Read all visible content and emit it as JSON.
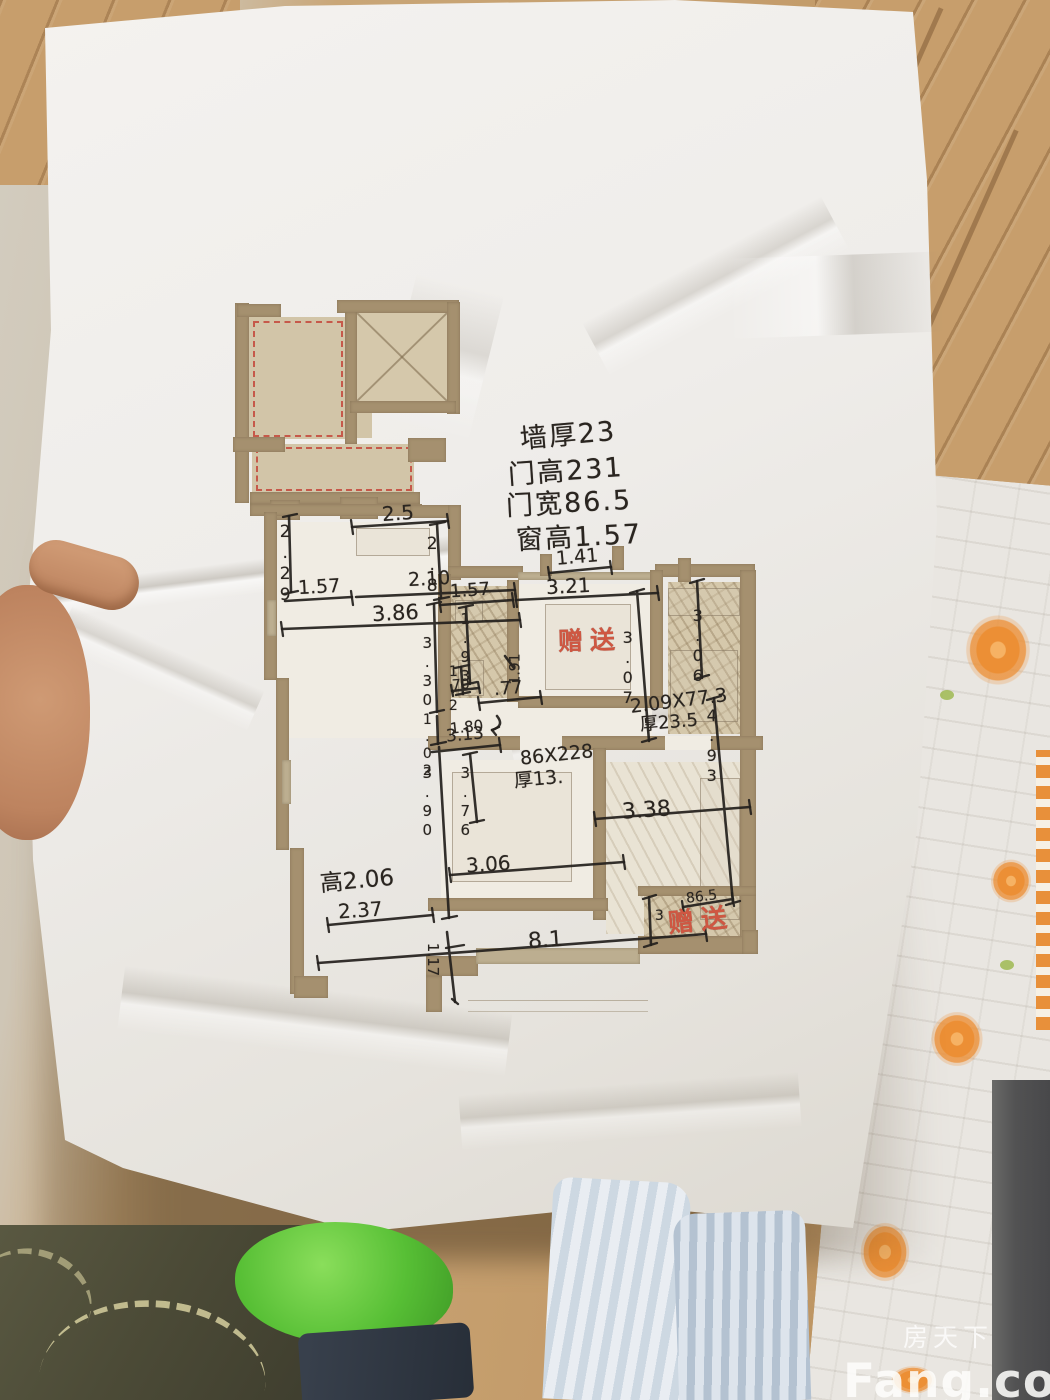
{
  "photo": {
    "watermark": {
      "site_cn": "房天下",
      "site_en": "Fang.com"
    },
    "handwritten_notes": [
      {
        "text": "墙厚23",
        "x": 520,
        "y": 422,
        "rot": -5,
        "size": 27
      },
      {
        "text": "门高231",
        "x": 508,
        "y": 458,
        "rot": -4,
        "size": 27
      },
      {
        "text": "门宽86.5",
        "x": 506,
        "y": 490,
        "rot": -3,
        "size": 27
      },
      {
        "text": "窗高1.57",
        "x": 516,
        "y": 524,
        "rot": -3,
        "size": 27
      }
    ],
    "gift_labels": [
      {
        "text": "赠送",
        "x": 558,
        "y": 628,
        "rot": -2,
        "size": 25
      },
      {
        "text": "赠送",
        "x": 668,
        "y": 908,
        "rot": -6,
        "size": 26
      }
    ],
    "dimensions": [
      {
        "text": "2.29",
        "x": 277,
        "y": 522,
        "dir": "v",
        "size": 17
      },
      {
        "text": "2.5",
        "x": 382,
        "y": 503,
        "dir": "h",
        "size": 20,
        "rot": -4
      },
      {
        "text": "2.8",
        "x": 424,
        "y": 534,
        "dir": "v",
        "size": 17
      },
      {
        "text": "1.41",
        "x": 556,
        "y": 548,
        "dir": "h",
        "size": 19,
        "rot": -5
      },
      {
        "text": "1.57",
        "x": 298,
        "y": 578,
        "dir": "h",
        "size": 19,
        "rot": -3
      },
      {
        "text": "2.10",
        "x": 408,
        "y": 570,
        "dir": "h",
        "size": 19,
        "rot": -3
      },
      {
        "text": "3.86",
        "x": 372,
        "y": 603,
        "dir": "h",
        "size": 21,
        "rot": -3
      },
      {
        "text": "1.57",
        "x": 450,
        "y": 582,
        "dir": "h",
        "size": 18,
        "rot": -4
      },
      {
        "text": "3.21",
        "x": 546,
        "y": 576,
        "dir": "h",
        "size": 20,
        "rot": -3
      },
      {
        "text": "1.93",
        "x": 458,
        "y": 610,
        "dir": "v",
        "size": 15
      },
      {
        "text": "70",
        "x": 452,
        "y": 678,
        "dir": "h",
        "size": 14,
        "rot": -4
      },
      {
        "text": ".77",
        "x": 494,
        "y": 680,
        "dir": "h",
        "size": 18,
        "rot": -4
      },
      {
        "text": "1.91",
        "x": 500,
        "y": 662,
        "dir": "r",
        "size": 14,
        "rot": -90
      },
      {
        "text": "3.30",
        "x": 420,
        "y": 634,
        "dir": "v",
        "size": 15
      },
      {
        "text": "1.2",
        "x": 446,
        "y": 664,
        "dir": "v",
        "size": 14
      },
      {
        "text": "1.80",
        "x": 450,
        "y": 720,
        "dir": "h",
        "size": 15,
        "rot": -6
      },
      {
        "text": "1.02",
        "x": 420,
        "y": 712,
        "dir": "v",
        "size": 14
      },
      {
        "text": "3.90",
        "x": 420,
        "y": 764,
        "dir": "v",
        "size": 15
      },
      {
        "text": "3.07",
        "x": 620,
        "y": 628,
        "dir": "v",
        "size": 16
      },
      {
        "text": "3.06",
        "x": 690,
        "y": 606,
        "dir": "v",
        "size": 16
      },
      {
        "text": "4.93",
        "x": 704,
        "y": 706,
        "dir": "v",
        "size": 16
      },
      {
        "text": "3.13",
        "x": 446,
        "y": 727,
        "dir": "h",
        "size": 17,
        "rot": -5
      },
      {
        "text": "3.76",
        "x": 458,
        "y": 764,
        "dir": "v",
        "size": 15
      },
      {
        "text": "86X228",
        "x": 520,
        "y": 746,
        "dir": "h",
        "size": 19,
        "rot": -6
      },
      {
        "text": "厚13.",
        "x": 514,
        "y": 770,
        "dir": "h",
        "size": 19,
        "rot": -5
      },
      {
        "text": "2.09X77.3",
        "x": 630,
        "y": 692,
        "dir": "h",
        "size": 19,
        "rot": -7
      },
      {
        "text": "厚23.5",
        "x": 640,
        "y": 714,
        "dir": "h",
        "size": 18,
        "rot": -5
      },
      {
        "text": "3.38",
        "x": 622,
        "y": 800,
        "dir": "h",
        "size": 22,
        "rot": -4
      },
      {
        "text": "3.06",
        "x": 466,
        "y": 854,
        "dir": "h",
        "size": 20,
        "rot": -4
      },
      {
        "text": "高2.06",
        "x": 320,
        "y": 870,
        "dir": "h",
        "size": 23,
        "rot": -5
      },
      {
        "text": "2.37",
        "x": 338,
        "y": 900,
        "dir": "h",
        "size": 20,
        "rot": -4
      },
      {
        "text": "8.1",
        "x": 528,
        "y": 930,
        "dir": "h",
        "size": 22,
        "rot": -4
      },
      {
        "text": "1.17",
        "x": 416,
        "y": 952,
        "dir": "r",
        "size": 15,
        "rot": 90
      },
      {
        "text": "86.5",
        "x": 686,
        "y": 890,
        "dir": "h",
        "size": 14,
        "rot": -7
      },
      {
        "text": "3",
        "x": 652,
        "y": 908,
        "dir": "v",
        "size": 14
      }
    ]
  }
}
